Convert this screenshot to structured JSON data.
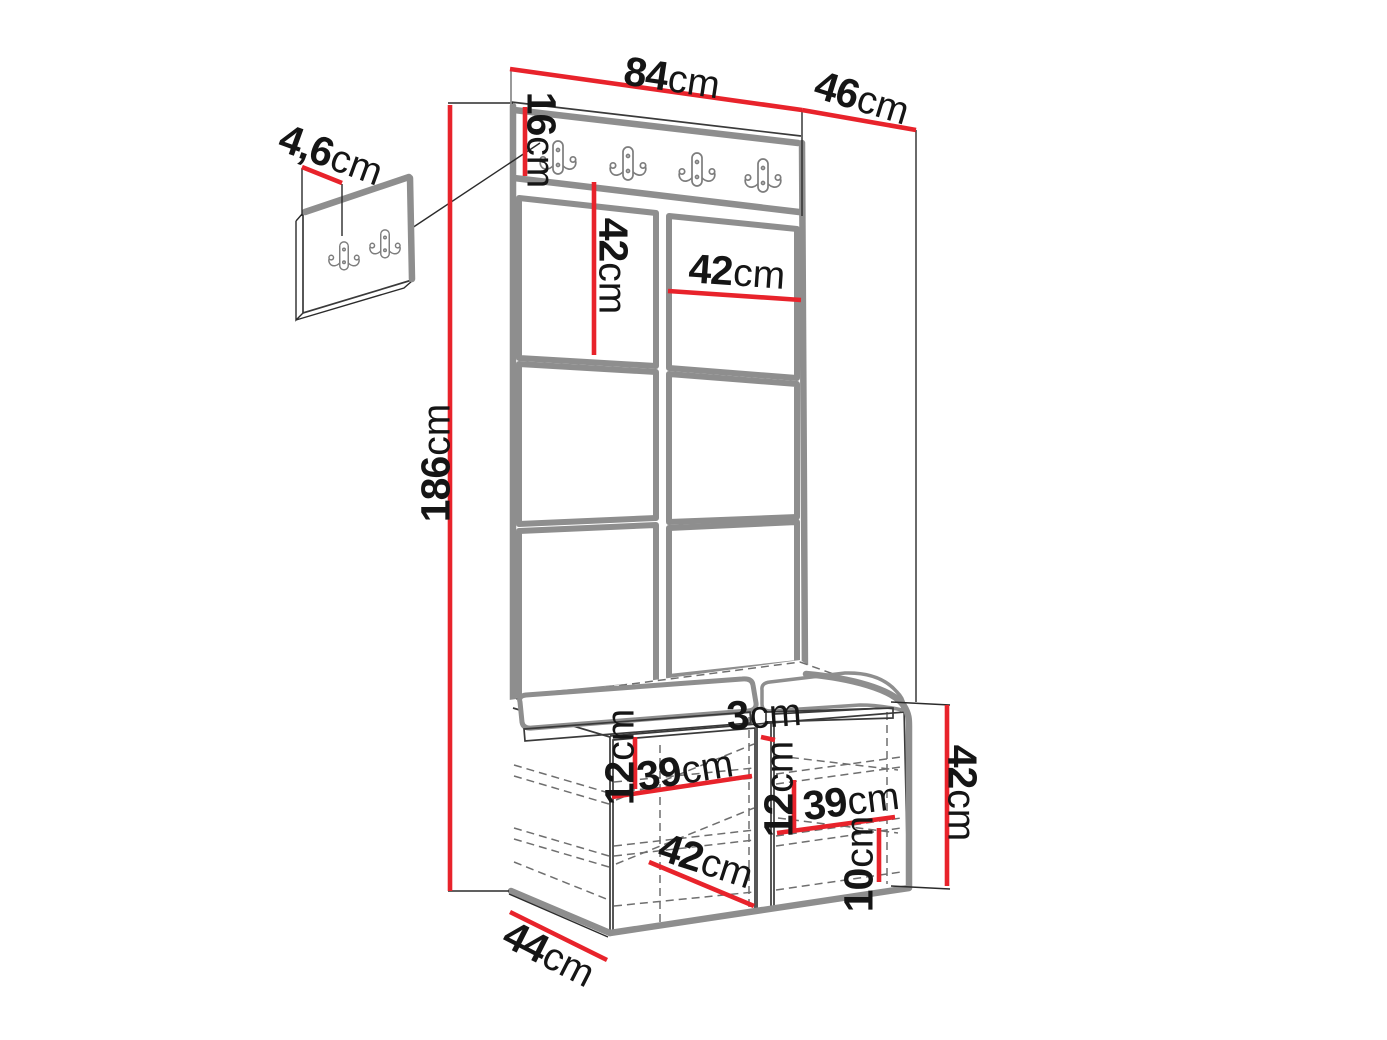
{
  "diagram": {
    "kind": "furniture-dimension-drawing",
    "colors": {
      "dimension_red": "#e8232b",
      "outline_gray": "#8e8e8e",
      "line_black": "#2b2b2b",
      "text": "#151515"
    },
    "icons": {
      "coat_hook": "double-coat-hook-icon",
      "rail_hook_count": 4,
      "wall_panel_hook_count": 2
    }
  },
  "dims": {
    "top_width": {
      "num": "84",
      "unit": "cm"
    },
    "top_depth": {
      "num": "46",
      "unit": "cm"
    },
    "rail_height": {
      "num": "16",
      "unit": "cm"
    },
    "tile_height": {
      "num": "42",
      "unit": "cm"
    },
    "tile_width": {
      "num": "42",
      "unit": "cm"
    },
    "total_height": {
      "num": "186",
      "unit": "cm"
    },
    "hook_panel": {
      "num": "4,6",
      "unit": "cm"
    },
    "seat_gap": {
      "num": "3",
      "unit": "cm"
    },
    "left_shelf_gap": {
      "num": "12",
      "unit": "cm"
    },
    "left_inner_width": {
      "num": "39",
      "unit": "cm"
    },
    "right_shelf_gap": {
      "num": "12",
      "unit": "cm"
    },
    "right_inner_width": {
      "num": "39",
      "unit": "cm"
    },
    "bottom_gap": {
      "num": "10",
      "unit": "cm"
    },
    "bench_height": {
      "num": "42",
      "unit": "cm"
    },
    "bench_inner_diag": {
      "num": "42",
      "unit": "cm"
    },
    "bench_depth": {
      "num": "44",
      "unit": "cm"
    }
  }
}
